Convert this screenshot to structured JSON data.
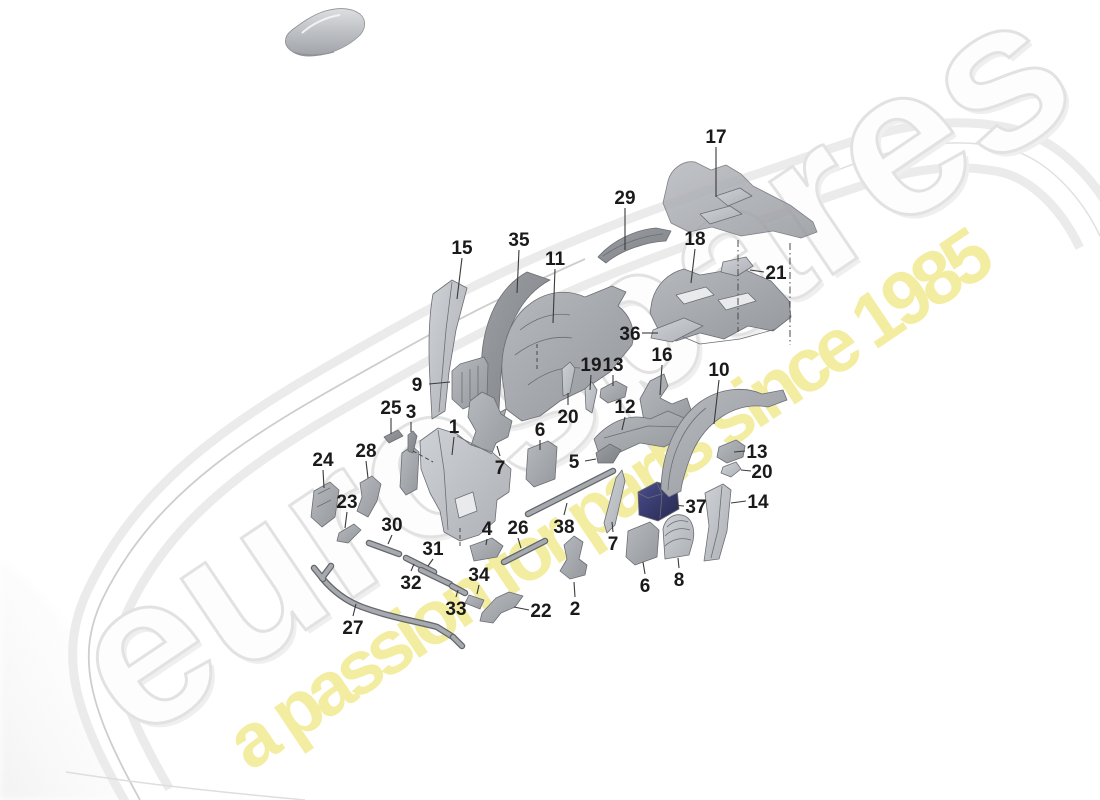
{
  "watermark": {
    "brand": "eurospares",
    "tagline": "a passion for parts since 1985",
    "brand_fill": "#fdfdfd",
    "brand_outline": "#e2e2e2",
    "tagline_color": "#f3eda2",
    "angle_deg": -34
  },
  "diagram": {
    "background": "#ffffff",
    "label_color": "#1a1a1a",
    "leader_color": "#3a3a3a",
    "part_gray_light": "#c3c6cb",
    "part_gray_mid": "#aaadb3",
    "part_gray_dark": "#8f9298",
    "part_navy": "#31336b",
    "labels": [
      {
        "t": "17",
        "x": 716,
        "y": 136,
        "l": [
          716,
          147,
          716,
          197
        ]
      },
      {
        "t": "29",
        "x": 625,
        "y": 197,
        "l": [
          625,
          208,
          625,
          250
        ]
      },
      {
        "t": "15",
        "x": 462,
        "y": 247,
        "l": [
          462,
          258,
          457,
          299
        ]
      },
      {
        "t": "35",
        "x": 519,
        "y": 239,
        "l": [
          519,
          250,
          517,
          293
        ]
      },
      {
        "t": "11",
        "x": 555,
        "y": 258,
        "l": [
          555,
          269,
          553,
          323
        ]
      },
      {
        "t": "18",
        "x": 695,
        "y": 238,
        "l": [
          695,
          249,
          691,
          283
        ]
      },
      {
        "t": "21",
        "x": 776,
        "y": 272,
        "l": [
          764,
          272,
          750,
          270
        ]
      },
      {
        "t": "36",
        "x": 630,
        "y": 333,
        "l": [
          642,
          333,
          658,
          333
        ]
      },
      {
        "t": "19",
        "x": 591,
        "y": 364,
        "l": [
          591,
          375,
          590,
          390
        ]
      },
      {
        "t": "13",
        "x": 613,
        "y": 364,
        "l": [
          613,
          375,
          613,
          386
        ]
      },
      {
        "t": "16",
        "x": 662,
        "y": 354,
        "l": [
          662,
          365,
          660,
          395
        ]
      },
      {
        "t": "10",
        "x": 719,
        "y": 369,
        "l": [
          719,
          380,
          714,
          424
        ]
      },
      {
        "t": "9",
        "x": 417,
        "y": 384,
        "l": [
          429,
          384,
          450,
          382
        ]
      },
      {
        "t": "25",
        "x": 391,
        "y": 407,
        "l": [
          391,
          418,
          391,
          434
        ]
      },
      {
        "t": "3",
        "x": 411,
        "y": 411,
        "l": [
          411,
          422,
          411,
          432
        ]
      },
      {
        "t": "20",
        "x": 568,
        "y": 416,
        "l": [
          568,
          405,
          568,
          393
        ]
      },
      {
        "t": "12",
        "x": 625,
        "y": 406,
        "l": [
          625,
          417,
          622,
          430
        ]
      },
      {
        "t": "1",
        "x": 454,
        "y": 426,
        "l": [
          454,
          437,
          452,
          455
        ]
      },
      {
        "t": "6",
        "x": 540,
        "y": 429,
        "l": [
          540,
          440,
          540,
          450
        ]
      },
      {
        "t": "28",
        "x": 366,
        "y": 450,
        "l": [
          366,
          461,
          368,
          478
        ]
      },
      {
        "t": "24",
        "x": 323,
        "y": 459,
        "l": [
          323,
          470,
          324,
          488
        ]
      },
      {
        "t": "13",
        "x": 757,
        "y": 451,
        "l": [
          745,
          451,
          734,
          452
        ]
      },
      {
        "t": "5",
        "x": 574,
        "y": 461,
        "l": [
          585,
          461,
          596,
          459
        ]
      },
      {
        "t": "7",
        "x": 500,
        "y": 467,
        "l": [
          500,
          456,
          497,
          446
        ]
      },
      {
        "t": "20",
        "x": 762,
        "y": 471,
        "l": [
          751,
          471,
          741,
          470
        ]
      },
      {
        "t": "23",
        "x": 347,
        "y": 501,
        "l": [
          347,
          512,
          345,
          528
        ]
      },
      {
        "t": "14",
        "x": 758,
        "y": 501,
        "l": [
          746,
          501,
          731,
          503
        ]
      },
      {
        "t": "37",
        "x": 696,
        "y": 506,
        "l": [
          684,
          506,
          672,
          505
        ]
      },
      {
        "t": "30",
        "x": 392,
        "y": 524,
        "l": [
          392,
          535,
          388,
          544
        ]
      },
      {
        "t": "26",
        "x": 518,
        "y": 527,
        "l": [
          518,
          538,
          521,
          548
        ]
      },
      {
        "t": "38",
        "x": 564,
        "y": 526,
        "l": [
          564,
          515,
          567,
          503
        ]
      },
      {
        "t": "4",
        "x": 487,
        "y": 528,
        "l": [
          487,
          539,
          486,
          545
        ]
      },
      {
        "t": "7",
        "x": 613,
        "y": 543,
        "l": [
          613,
          532,
          612,
          522
        ]
      },
      {
        "t": "31",
        "x": 433,
        "y": 548,
        "l": [
          433,
          559,
          428,
          566
        ]
      },
      {
        "t": "34",
        "x": 479,
        "y": 574,
        "l": [
          479,
          585,
          477,
          594
        ]
      },
      {
        "t": "32",
        "x": 411,
        "y": 582,
        "l": [
          411,
          571,
          414,
          564
        ]
      },
      {
        "t": "2",
        "x": 575,
        "y": 608,
        "l": [
          575,
          597,
          574,
          582
        ]
      },
      {
        "t": "33",
        "x": 456,
        "y": 608,
        "l": [
          456,
          597,
          458,
          590
        ]
      },
      {
        "t": "22",
        "x": 541,
        "y": 610,
        "l": [
          529,
          610,
          514,
          607
        ]
      },
      {
        "t": "6",
        "x": 645,
        "y": 585,
        "l": [
          645,
          574,
          643,
          562
        ]
      },
      {
        "t": "8",
        "x": 679,
        "y": 579,
        "l": [
          679,
          568,
          678,
          558
        ]
      },
      {
        "t": "27",
        "x": 353,
        "y": 627,
        "l": [
          353,
          616,
          356,
          604
        ]
      }
    ],
    "parts": [
      {
        "n": "heat-shield-17",
        "f": "M",
        "o": 0.85,
        "d": "M668,181 C671,169 683,160 695,162 L711,170 L726,165 L741,174 L753,186 L790,205 L813,222 L817,232 L801,238 L773,231 L741,236 L712,227 L689,232 L671,223 L663,203 Z"
      },
      {
        "n": "heat-shield-17-tab",
        "f": "L",
        "d": "M716,196 L740,188 L752,196 L728,206 Z"
      },
      {
        "n": "heat-shield-17-tab2",
        "f": "L",
        "d": "M700,214 L730,206 L742,214 L710,224 Z"
      },
      {
        "n": "strip-29",
        "f": "D",
        "d": "M598,257 C612,241 634,230 656,228 L671,231 L666,241 C645,242 620,251 606,263 Z"
      },
      {
        "n": "strip-29-edge",
        "f": "none",
        "d": "M603,256 C620,244 642,236 663,234"
      },
      {
        "n": "bracket-18",
        "f": "M",
        "d": "M652,301 C656,285 668,273 684,269 L700,275 L741,268 L771,281 L789,301 L791,317 L773,331 L748,326 L724,339 L700,333 L676,341 L658,329 L650,313 Z"
      },
      {
        "n": "bracket-18-slot",
        "f": "W",
        "d": "M676,295 L706,287 L714,295 L684,304 Z"
      },
      {
        "n": "bracket-18-slot2",
        "f": "W",
        "d": "M718,300 L748,293 L756,301 L726,310 Z"
      },
      {
        "n": "bracket-18-lower",
        "f": "none",
        "d": "M662,328 L700,344 L740,339 L776,329"
      },
      {
        "n": "plate-21",
        "f": "L",
        "d": "M723,262 L746,257 L753,266 L737,276 L721,272 Z"
      },
      {
        "n": "plate-36",
        "f": "L",
        "d": "M653,330 L684,318 L703,326 L672,342 L651,338 Z"
      },
      {
        "n": "panel-15",
        "f": "L",
        "d": "M433,294 L452,280 L467,288 L456,330 L449,372 L445,411 L432,419 L430,381 C428,345 429,316 433,294 Z"
      },
      {
        "n": "panel-15-edge",
        "f": "none",
        "d": "M452,282 L446,330 L439,412"
      },
      {
        "n": "arch-35",
        "f": "D",
        "d": "M483,390 C476,336 494,290 527,272 L550,280 C520,296 504,330 501,375 L498,426 L486,419 Z"
      },
      {
        "n": "wheelhouse-11",
        "f": "M",
        "d": "M504,389 C498,360 505,331 520,313 C540,291 565,288 585,297 L612,286 L626,292 L618,306 C630,315 636,330 632,345 L610,372 L585,389 L560,401 L540,416 L522,421 L506,409 Z"
      },
      {
        "n": "wheelhouse-11-ridges",
        "f": "none",
        "d": "M520,330 C535,318 553,312 570,315 M515,355 C532,342 552,335 572,338 M528,385 C545,372 562,366 580,368"
      },
      {
        "n": "wheelhouse-11-tail",
        "f": "M",
        "d": "M506,409 L498,441 L488,453 L483,441 L493,416 Z"
      },
      {
        "n": "block-9",
        "f": "M",
        "d": "M452,371 L460,364 L484,357 L488,364 L487,398 L463,409 L452,399 Z"
      },
      {
        "n": "block-9-ribs",
        "f": "none",
        "d": "M462,372 L462,403 M470,369 L470,400 M478,366 L478,396"
      },
      {
        "n": "pin-20a",
        "f": "L",
        "d": "M562,369 L570,362 L575,368 L570,393 L563,396 Z"
      },
      {
        "n": "pin-19",
        "f": "L",
        "d": "M585,389 L592,382 L597,390 L592,413 L586,409 Z"
      },
      {
        "n": "block-13a",
        "f": "M",
        "d": "M601,389 L616,381 L627,387 L625,397 L608,403 L600,397 Z"
      },
      {
        "n": "bracket-16",
        "f": "M",
        "d": "M640,399 L650,381 L664,374 L668,386 L660,398 L672,404 L687,398 L691,410 L677,427 L658,433 L644,421 Z"
      },
      {
        "n": "rail-12",
        "f": "M",
        "d": "M594,439 C610,421 630,413 650,419 L668,411 L691,421 L687,435 L664,447 L640,443 L618,453 L598,451 Z"
      },
      {
        "n": "rail-12-detail",
        "f": "none",
        "d": "M604,438 L648,426 M648,426 L682,427"
      },
      {
        "n": "bracket-5",
        "f": "D",
        "d": "M596,453 L610,444 L621,450 L613,463 L598,463 Z"
      },
      {
        "n": "pad-6a",
        "f": "M",
        "d": "M528,449 L548,441 L557,447 L555,479 L534,487 L526,479 Z"
      },
      {
        "n": "bracket-7a",
        "f": "M",
        "d": "M470,401 L482,392 L494,398 L501,414 L512,421 L508,437 L496,443 L490,458 L478,463 L469,451 L476,431 L468,417 Z"
      },
      {
        "n": "panel-1",
        "f": "L",
        "d": "M420,441 L438,428 L457,434 L471,445 L492,452 L511,469 L509,492 L497,500 L495,521 L479,535 L460,541 L444,532 L440,511 L430,493 L421,469 Z"
      },
      {
        "n": "panel-1-hole",
        "f": "W",
        "d": "M455,499 L473,492 L477,511 L459,518 Z"
      },
      {
        "n": "panel-1-facets",
        "f": "none",
        "d": "M438,430 L444,470 L448,530 M457,436 L492,454"
      },
      {
        "n": "bracket-left-of-1",
        "f": "M",
        "d": "M402,453 L412,446 L419,452 L417,489 L406,495 L400,487 Z"
      },
      {
        "n": "pin-3",
        "f": "D",
        "d": "M408,435 L413,431 L417,436 L413,453 L408,451 Z"
      },
      {
        "n": "strip-25",
        "f": "D",
        "d": "M384,437 L398,430 L403,436 L389,443 Z"
      },
      {
        "n": "plate-24",
        "f": "M",
        "d": "M314,491 L330,482 L339,490 L335,517 L322,527 L311,517 Z"
      },
      {
        "n": "plate-24-facet",
        "f": "none",
        "d": "M318,494 L330,488 M317,507 L331,500"
      },
      {
        "n": "bracket-28",
        "f": "M",
        "d": "M360,483 L372,476 L381,484 L377,501 L368,517 L357,511 L362,497 Z"
      },
      {
        "n": "clip-23",
        "f": "M",
        "d": "M339,533 L354,524 L361,530 L348,543 L337,541 Z"
      },
      {
        "n": "foot-4",
        "f": "M",
        "d": "M470,546 L492,538 L503,546 L497,557 L474,561 Z"
      },
      {
        "n": "clip-34",
        "f": "M",
        "d": "M469,595 L484,600 L480,609 L465,603 Z"
      },
      {
        "n": "bracket-22",
        "f": "M",
        "d": "M482,613 L496,598 L509,592 L523,596 L515,607 L501,613 L493,623 L480,621 Z"
      },
      {
        "n": "bracket-2",
        "f": "M",
        "d": "M564,545 L574,536 L583,542 L579,559 L587,565 L585,575 L570,579 L560,571 L567,559 Z"
      },
      {
        "n": "strip-7b",
        "f": "L",
        "d": "M604,523 L616,478 L622,470 L625,481 L615,525 L607,533 Z"
      },
      {
        "n": "block-37",
        "f": "N",
        "d": "M638,492 L657,482 L677,488 L679,509 L658,521 L639,515 Z"
      },
      {
        "n": "block-37-facet",
        "f": "noneL",
        "d": "M657,483 L662,494 L660,518 M638,493 L648,498 L662,494"
      },
      {
        "n": "pad-6b",
        "f": "M",
        "d": "M628,531 L650,522 L659,530 L657,557 L635,565 L626,557 Z"
      },
      {
        "n": "pad-8",
        "f": "L",
        "d": "M663,529 C665,518 675,512 685,516 C693,520 695,531 693,541 L689,555 L665,559 Z"
      },
      {
        "n": "pad-8-ribs",
        "f": "none",
        "d": "M667,527 C673,521 681,519 688,522 M665,536 C672,529 681,527 690,530 M665,546 C672,539 682,537 691,540"
      },
      {
        "n": "panel-14",
        "f": "L",
        "d": "M705,493 L723,484 L731,490 L727,531 L719,559 L704,561 L709,526 Z"
      },
      {
        "n": "panel-14-edge",
        "f": "none",
        "d": "M722,486 L718,530 L711,558"
      },
      {
        "n": "block-13b",
        "f": "M",
        "d": "M719,447 L736,440 L745,446 L743,457 L727,463 L717,457 Z"
      },
      {
        "n": "clip-20b",
        "f": "L",
        "d": "M723,467 L736,462 L741,469 L731,477 L721,473 Z"
      },
      {
        "n": "arch-10",
        "f": "M",
        "d": "M661,489 C662,452 676,420 700,402 C720,388 744,386 762,394 L783,390 L787,400 L768,407 C736,401 706,421 692,453 C685,470 681,487 681,491 L669,497 Z"
      },
      {
        "n": "arch-10-edge",
        "f": "none",
        "d": "M668,490 C670,455 684,425 706,408"
      }
    ],
    "tubes": [
      {
        "n": "tube-27",
        "d": "M322,578 C332,590 346,601 362,607 C392,618 420,622 437,627 L453,637"
      },
      {
        "n": "tube-27-fork",
        "d": "M314,568 L323,579 M331,566 L322,578 M453,637 L462,646"
      },
      {
        "n": "tube-30",
        "d": "M369,543 L399,554"
      },
      {
        "n": "tube-31",
        "d": "M406,558 L434,572"
      },
      {
        "n": "tube-32",
        "d": "M421,570 L450,584"
      },
      {
        "n": "tube-33",
        "d": "M452,586 L465,593"
      },
      {
        "n": "tube-26",
        "d": "M504,562 L545,541"
      },
      {
        "n": "tube-38",
        "d": "M528,514 L613,471"
      }
    ],
    "dash_lines": [
      {
        "d": "M738,240 L738,332",
        "s": "7 3 1.5 3"
      },
      {
        "d": "M790,243 L790,345",
        "s": "7 3 1.5 3"
      },
      {
        "d": "M460,528 L460,547",
        "s": "4 3"
      },
      {
        "d": "M413,451 L433,462",
        "s": "4 3"
      },
      {
        "d": "M537,344 L537,369",
        "s": "4 3"
      }
    ]
  }
}
